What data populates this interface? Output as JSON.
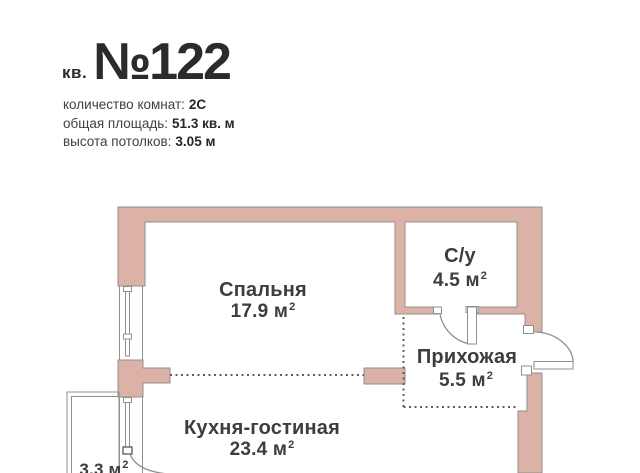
{
  "header": {
    "unit_prefix": "кв.",
    "unit_number": "№122",
    "details": [
      {
        "label": "количество комнат:",
        "value": "2С"
      },
      {
        "label": "общая площадь:",
        "value": "51.3 кв. м"
      },
      {
        "label": "высота потолков:",
        "value": "3.05 м"
      }
    ]
  },
  "floor_plan": {
    "rooms": [
      {
        "name": "Спальня",
        "area": "17.9 м",
        "area_sup": "2"
      },
      {
        "name": "С/у",
        "area": "4.5 м",
        "area_sup": "2"
      },
      {
        "name": "Прихожая",
        "area": "5.5 м",
        "area_sup": "2"
      },
      {
        "name": "Кухня-гостиная",
        "area": "23.4 м",
        "area_sup": "2"
      },
      {
        "name": "",
        "area": "3.3 м",
        "area_sup": "2"
      }
    ]
  },
  "colors": {
    "wall_fill": "#dbb2a5",
    "wall_border": "#8f8f8f",
    "line": "#8f8f8f",
    "dash": "#5f5f5f",
    "text": "#3d3d3d",
    "title": "#2b2b2b"
  }
}
